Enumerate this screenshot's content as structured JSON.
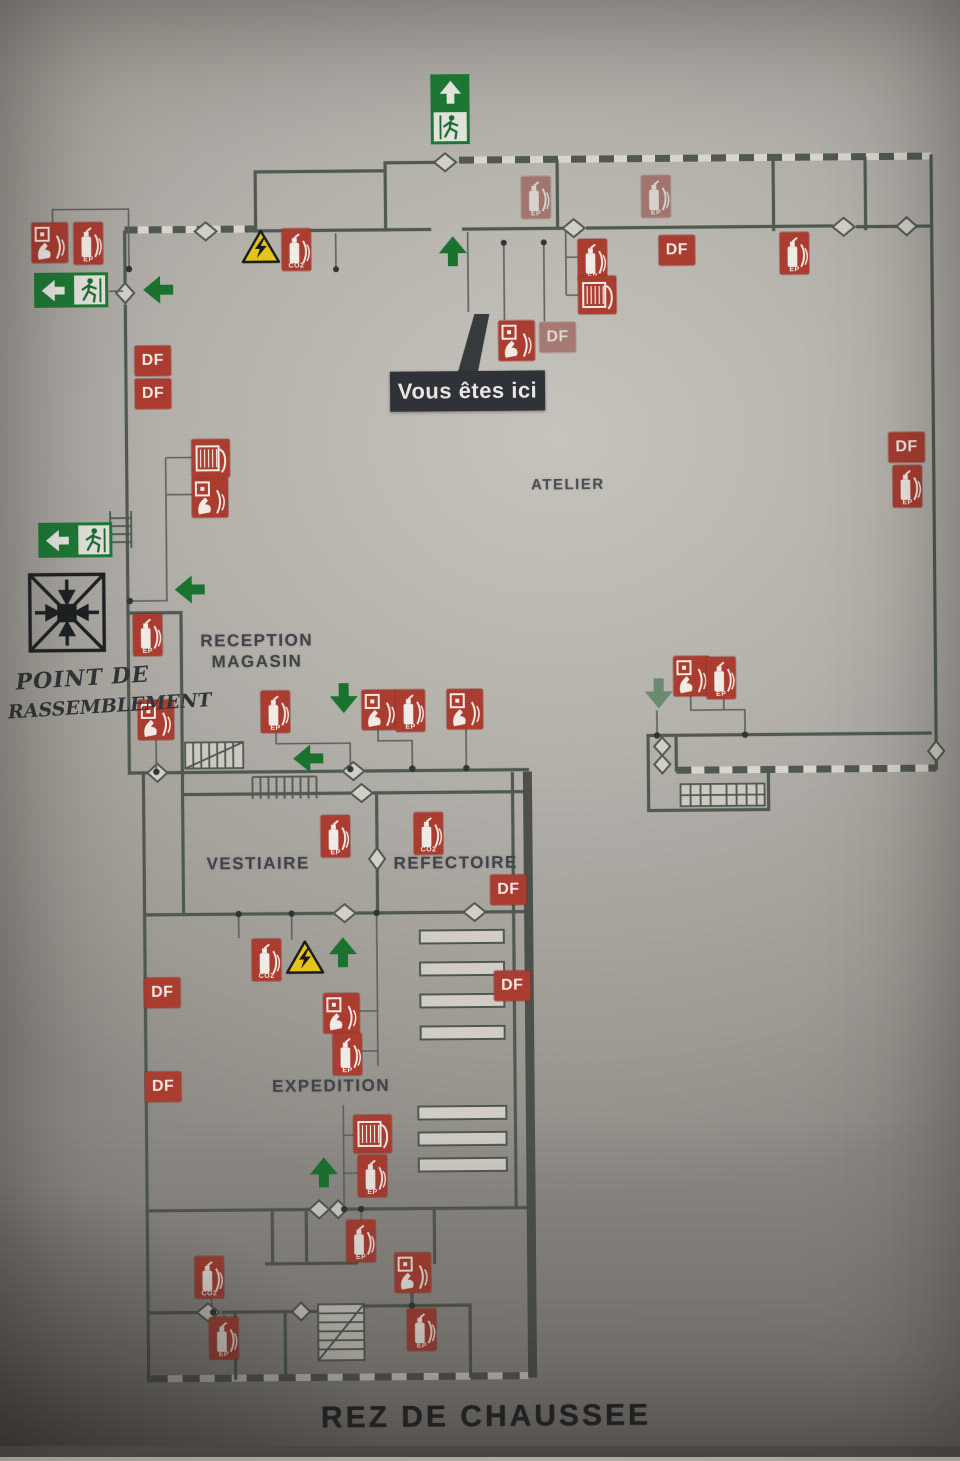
{
  "title": "REZ DE CHAUSSEE",
  "you_are_here": "Vous êtes ici",
  "assembly_point": {
    "line1": "POINT DE",
    "line2": "RASSEMBLEMENT"
  },
  "rooms": {
    "atelier": "ATELIER",
    "reception_line1": "RECEPTION",
    "reception_line2": "MAGASIN",
    "vestiaire": "VESTIAIRE",
    "refectoire": "REFECTOIRE",
    "expedition": "EXPEDITION"
  },
  "legend_labels": {
    "df": "DF",
    "ep": "EP",
    "co2": "CO2"
  },
  "colors": {
    "safety_red": "#ac3a2e",
    "safety_green": "#1a7a33",
    "warning_yellow": "#e9c716",
    "wall": "#4e584e",
    "badge_dark": "#2d3135"
  },
  "markers": [
    {
      "type": "exit_up",
      "x": 436,
      "y": 74
    },
    {
      "type": "exit_left",
      "x": 38,
      "y": 269
    },
    {
      "type": "exit_left",
      "x": 40,
      "y": 519
    },
    {
      "type": "arrow",
      "x": 145,
      "y": 270,
      "rot": -90
    },
    {
      "type": "arrow",
      "x": 440,
      "y": 234,
      "rot": 0
    },
    {
      "type": "arrow",
      "x": 174,
      "y": 570,
      "rot": -90
    },
    {
      "type": "arrow",
      "x": 327,
      "y": 680,
      "rot": 180
    },
    {
      "type": "arrow",
      "x": 291,
      "y": 740,
      "rot": -90
    },
    {
      "type": "arrow",
      "x": 642,
      "y": 678,
      "rot": 180,
      "faded": true
    },
    {
      "type": "arrow",
      "x": 324,
      "y": 934,
      "rot": 0
    },
    {
      "type": "arrow",
      "x": 303,
      "y": 1154,
      "rot": 0
    },
    {
      "type": "assembly",
      "x": 26,
      "y": 566
    },
    {
      "type": "elec_warning",
      "x": 245,
      "y": 227
    },
    {
      "type": "elec_warning",
      "x": 283,
      "y": 938
    },
    {
      "type": "df",
      "x": 138,
      "y": 343
    },
    {
      "type": "df",
      "x": 138,
      "y": 376
    },
    {
      "type": "df",
      "x": 663,
      "y": 237
    },
    {
      "type": "df",
      "x": 543,
      "y": 323,
      "faded": true
    },
    {
      "type": "df",
      "x": 891,
      "y": 436
    },
    {
      "type": "df",
      "x": 489,
      "y": 875
    },
    {
      "type": "df",
      "x": 492,
      "y": 971
    },
    {
      "type": "df",
      "x": 142,
      "y": 975
    },
    {
      "type": "df",
      "x": 142,
      "y": 1069
    },
    {
      "type": "call_point",
      "x": 36,
      "y": 219
    },
    {
      "type": "call_point",
      "x": 194,
      "y": 475
    },
    {
      "type": "call_point",
      "x": 138,
      "y": 697
    },
    {
      "type": "call_point",
      "x": 362,
      "y": 689
    },
    {
      "type": "call_point",
      "x": 447,
      "y": 689
    },
    {
      "type": "call_point",
      "x": 674,
      "y": 658
    },
    {
      "type": "call_point",
      "x": 502,
      "y": 321
    },
    {
      "type": "call_point",
      "x": 321,
      "y": 992
    },
    {
      "type": "call_point",
      "x": 390,
      "y": 1252
    },
    {
      "type": "extinguisher",
      "x": 78,
      "y": 219
    },
    {
      "type": "extinguisher",
      "x": 134,
      "y": 611
    },
    {
      "type": "extinguisher",
      "x": 261,
      "y": 689
    },
    {
      "type": "extinguisher",
      "x": 396,
      "y": 689
    },
    {
      "type": "extinguisher",
      "x": 707,
      "y": 659
    },
    {
      "type": "extinguisher",
      "x": 526,
      "y": 177,
      "faded": true
    },
    {
      "type": "extinguisher",
      "x": 646,
      "y": 177,
      "faded": true
    },
    {
      "type": "extinguisher",
      "x": 784,
      "y": 235
    },
    {
      "type": "extinguisher",
      "x": 582,
      "y": 240
    },
    {
      "type": "extinguisher",
      "x": 895,
      "y": 469
    },
    {
      "type": "extinguisher",
      "x": 320,
      "y": 814
    },
    {
      "type": "extinguisher",
      "x": 330,
      "y": 1032
    },
    {
      "type": "extinguisher",
      "x": 354,
      "y": 1154
    },
    {
      "type": "extinguisher",
      "x": 342,
      "y": 1219
    },
    {
      "type": "extinguisher",
      "x": 204,
      "y": 1315
    },
    {
      "type": "extinguisher",
      "x": 402,
      "y": 1308
    },
    {
      "type": "extinguisher_co2",
      "x": 286,
      "y": 227
    },
    {
      "type": "extinguisher_co2",
      "x": 250,
      "y": 937
    },
    {
      "type": "extinguisher_co2",
      "x": 413,
      "y": 812
    },
    {
      "type": "extinguisher_co2",
      "x": 190,
      "y": 1254
    },
    {
      "type": "hose_reel",
      "x": 194,
      "y": 437
    },
    {
      "type": "hose_reel",
      "x": 582,
      "y": 277
    },
    {
      "type": "hose_reel",
      "x": 350,
      "y": 1114
    }
  ]
}
